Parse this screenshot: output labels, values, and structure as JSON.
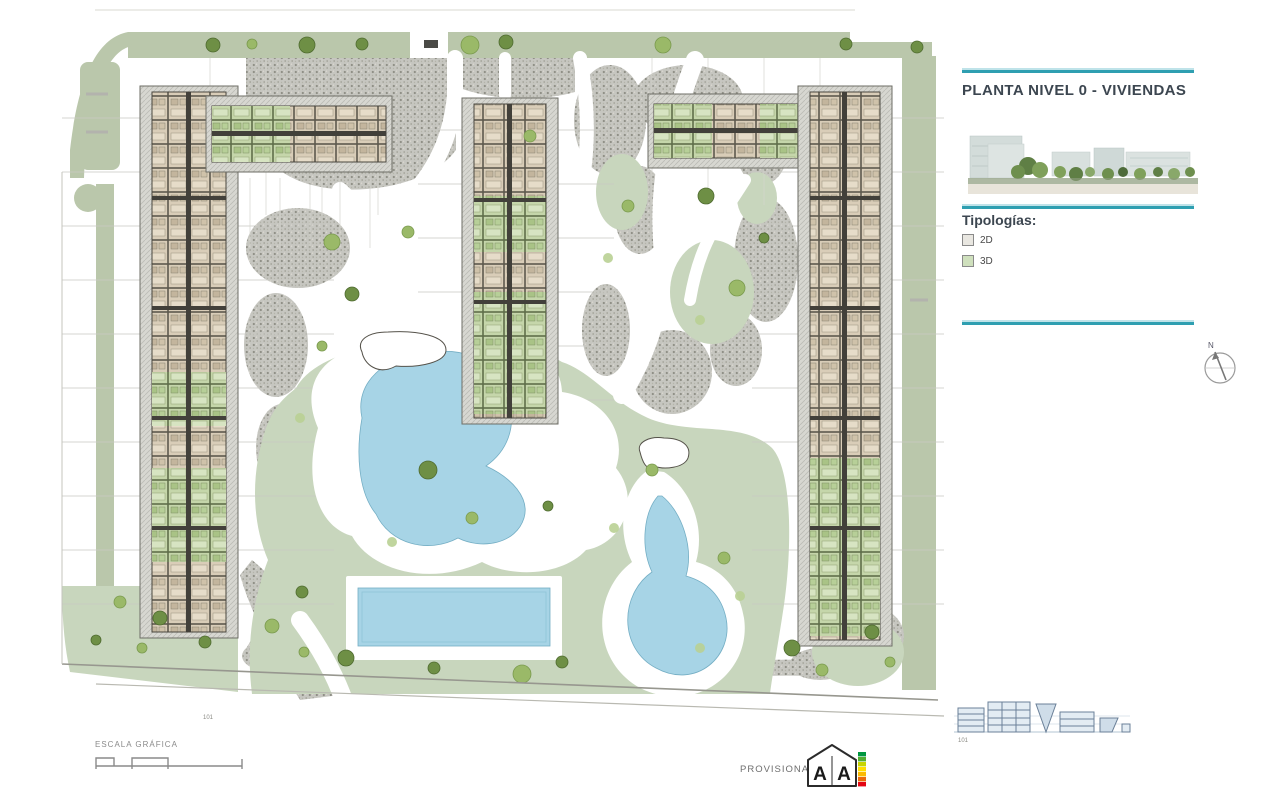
{
  "palette": {
    "accent_teal": "#2f9fb1",
    "title_text": "#3c4650",
    "site_green": "#bac7ab",
    "lawn": "#c8d6bd",
    "gravel": "#c6c6c0",
    "pool": "#a7d4e6",
    "deck": "#ffffff",
    "unit_beige": "#d9cdb8",
    "unit_green": "#c5d6aa",
    "tree_dark": "#6e8f45",
    "tree_light": "#9ab968"
  },
  "sidebar": {
    "title": "PLANTA NIVEL 0 - VIVIENDAS",
    "legend_title": "Tipologías:",
    "legend": [
      {
        "label": "2D",
        "color": "#e9e7e1"
      },
      {
        "label": "3D",
        "color": "#cfe0bd"
      }
    ],
    "north_label": "N",
    "elevation_caption": "101"
  },
  "plan": {
    "marker_label": "101"
  },
  "footer": {
    "scale_label": "ESCALA GRÁFICA",
    "provisional_label": "PROVISIONAL",
    "energy_badge": {
      "letters": [
        "A",
        "A"
      ],
      "bar_colors": [
        "#009640",
        "#52ae32",
        "#c8d400",
        "#ffde00",
        "#fbba00",
        "#eb6909",
        "#e30613"
      ]
    }
  }
}
